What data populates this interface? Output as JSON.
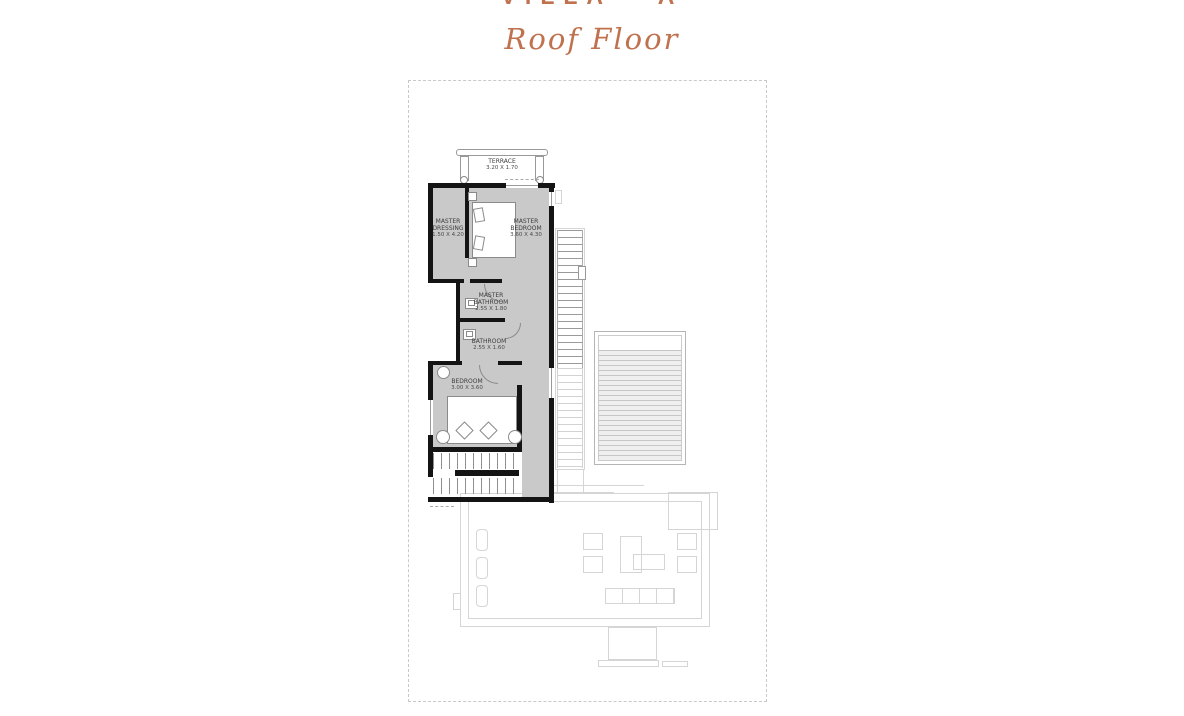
{
  "header": {
    "title": "VILLA - A",
    "subtitle": "Roof Floor"
  },
  "colors": {
    "accent": "#c0714e",
    "wall": "#141414",
    "room_fill": "#c9c9c9",
    "ghost_line": "#d5d5d5"
  },
  "rooms": {
    "terrace": {
      "name": "TERRACE",
      "dims": "3.20 X 1.70"
    },
    "master_dressing": {
      "name": "MASTER DRESSING",
      "dims": "1.50 X 4.20"
    },
    "master_bedroom": {
      "name": "MASTER BEDROOM",
      "dims": "3.60 X 4.30"
    },
    "master_bathroom": {
      "name": "MASTER BATHROOM",
      "dims": "2.55 X 1.80"
    },
    "bathroom": {
      "name": "BATHROOM",
      "dims": "2.55 X 1.60"
    },
    "bedroom": {
      "name": "BEDROOM",
      "dims": "3.00 X 3.60"
    }
  }
}
